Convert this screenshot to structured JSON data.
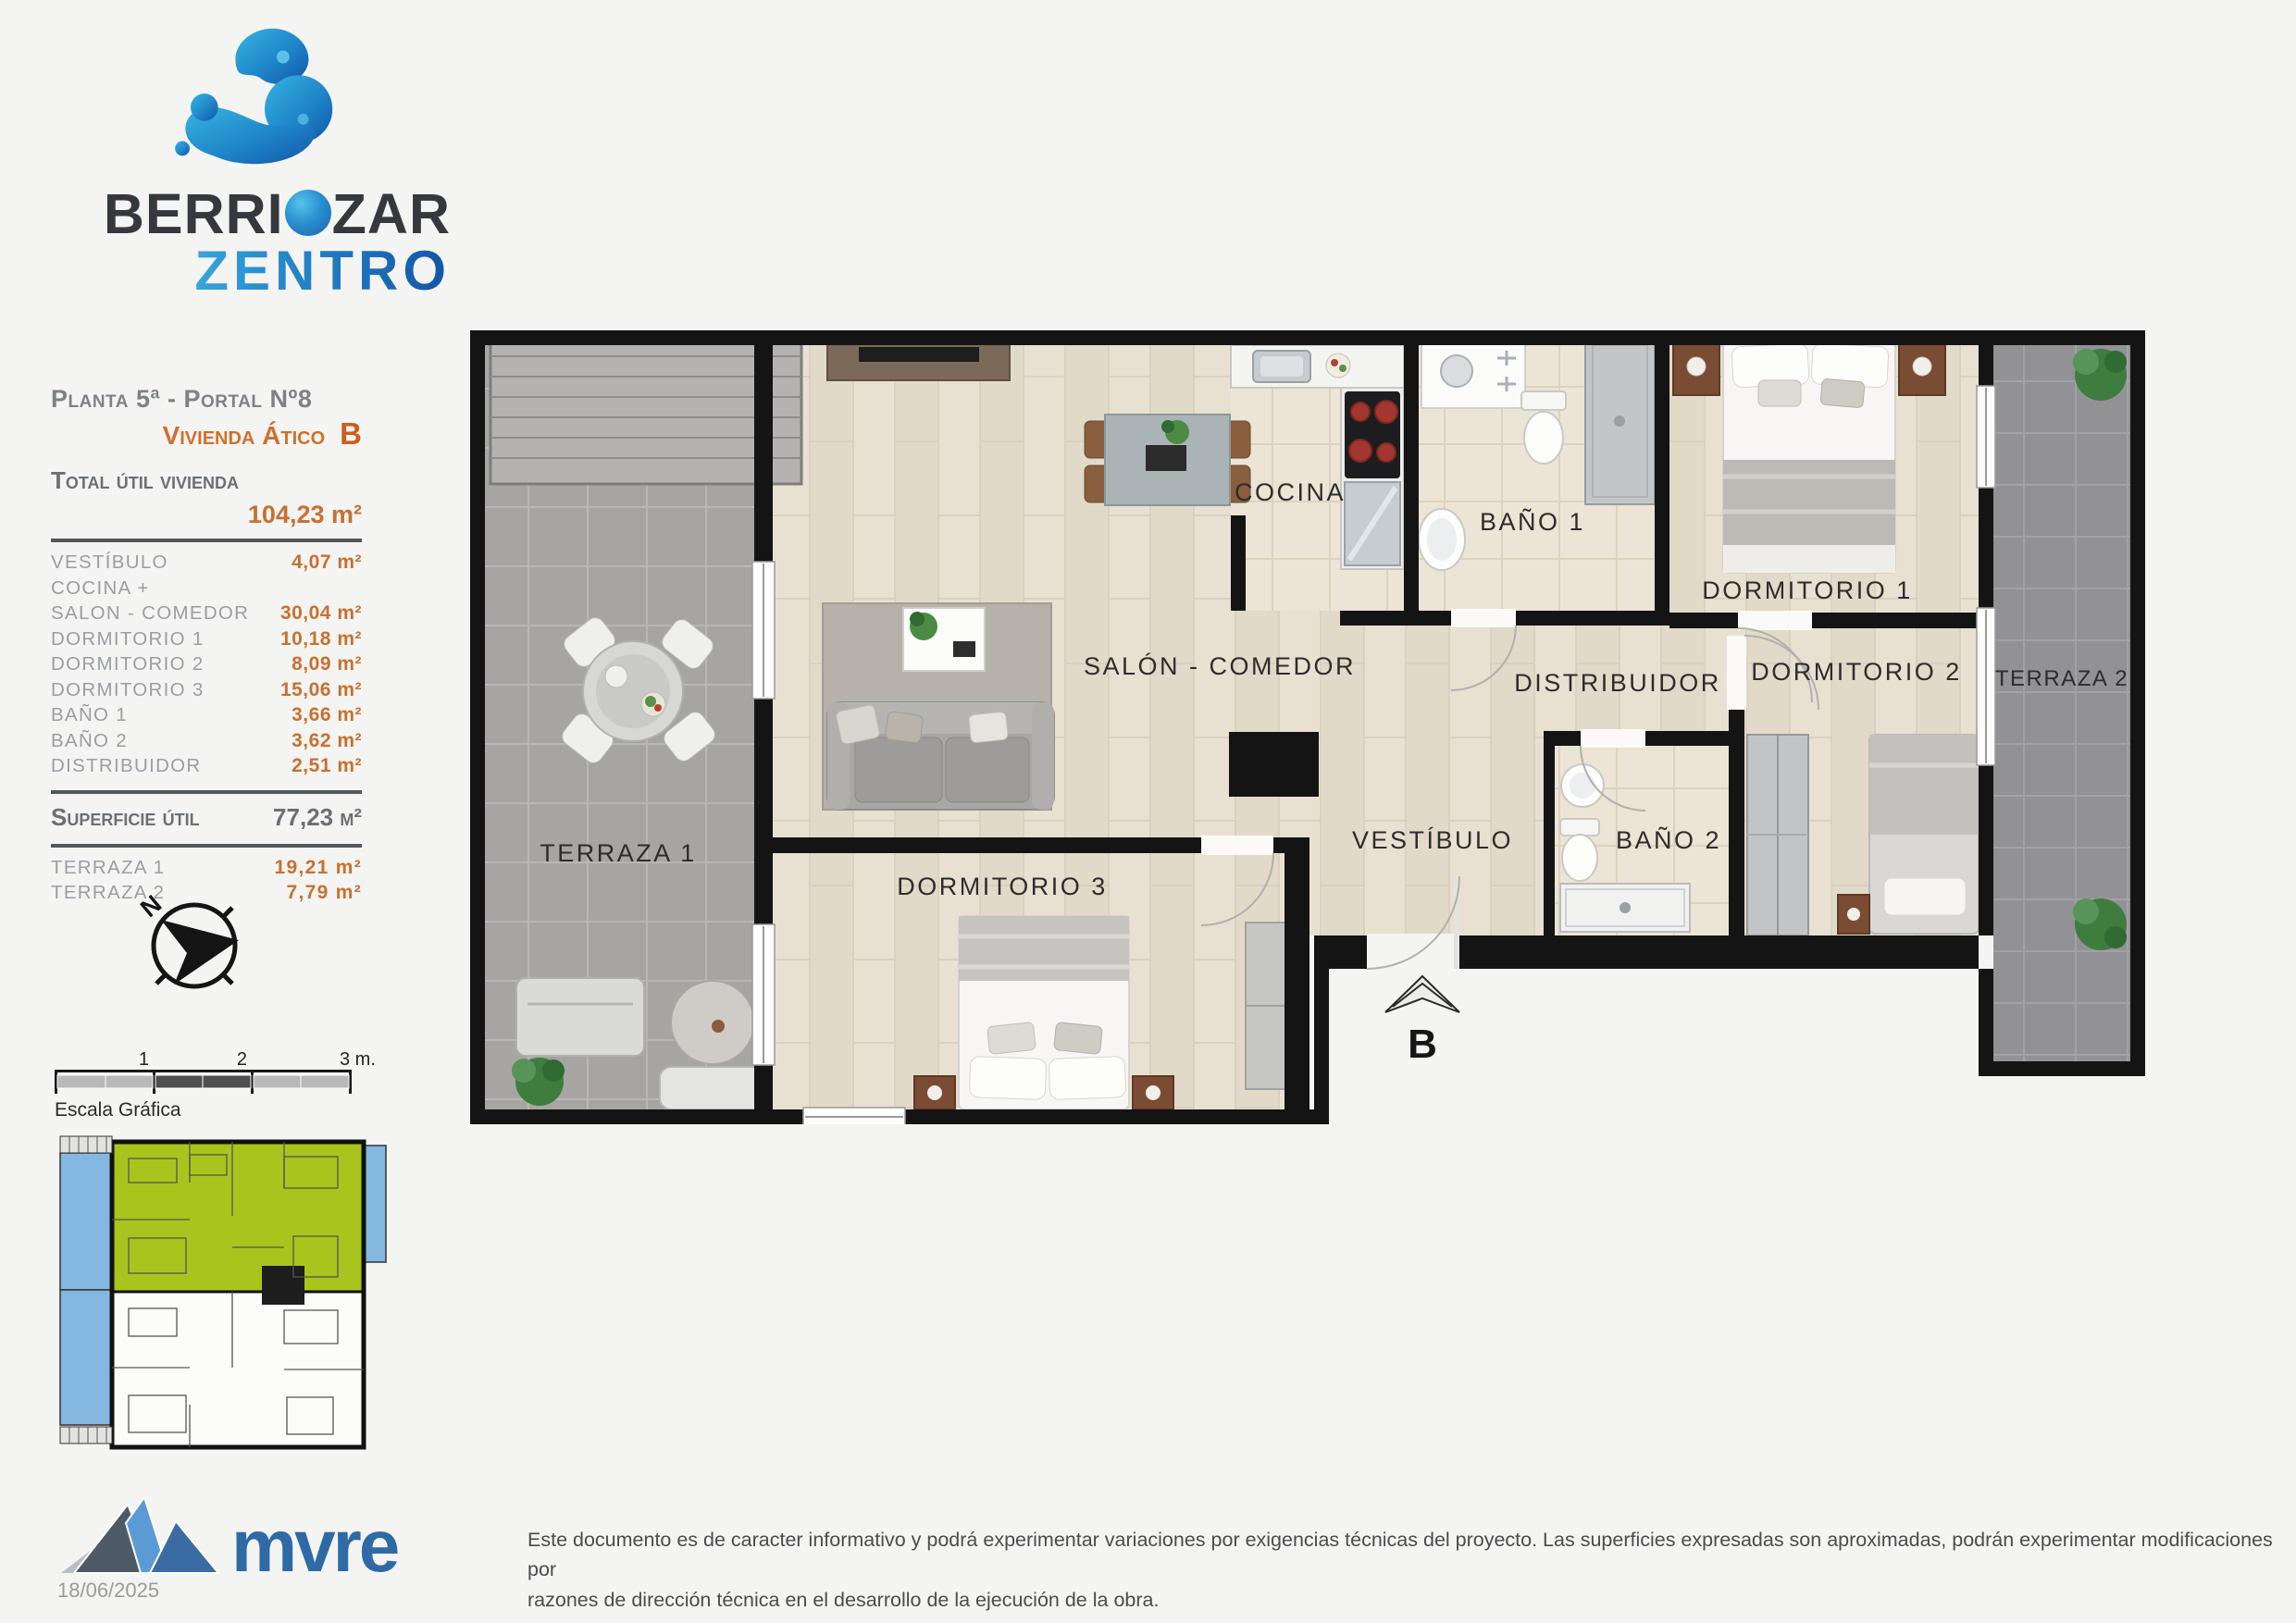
{
  "brand": {
    "prefix": "BERRI",
    "suffix": "ZAR",
    "bottom": "ZENTRO"
  },
  "info": {
    "planta": "Planta 5ª - Portal Nº8",
    "vivienda": "Vivienda Ático",
    "letra": "B",
    "total_label": "Total útil vivienda",
    "total_value": "104,23 m²",
    "rows": [
      {
        "label": "VESTÍBULO",
        "value": "4,07 m²"
      },
      {
        "label": "COCINA +",
        "value": ""
      },
      {
        "label": "SALON - COMEDOR",
        "value": "30,04 m²"
      },
      {
        "label": "DORMITORIO 1",
        "value": "10,18 m²"
      },
      {
        "label": "DORMITORIO 2",
        "value": "8,09 m²"
      },
      {
        "label": "DORMITORIO 3",
        "value": "15,06 m²"
      },
      {
        "label": "BAÑO 1",
        "value": "3,66 m²"
      },
      {
        "label": "BAÑO 2",
        "value": "3,62 m²"
      },
      {
        "label": "DISTRIBUIDOR",
        "value": "2,51 m²"
      }
    ],
    "superficie_label": "Superficie útil",
    "superficie_value": "77,23 m²",
    "terrazas": [
      {
        "label": "TERRAZA 1",
        "value": "19,21 m²"
      },
      {
        "label": "TERRAZA 2",
        "value": "7,79 m²"
      }
    ]
  },
  "plan": {
    "labels": {
      "terraza1": "TERRAZA 1",
      "salon": "SALÓN - COMEDOR",
      "cocina": "COCINA",
      "bano1": "BAÑO 1",
      "dormitorio1": "DORMITORIO 1",
      "distribuidor": "DISTRIBUIDOR",
      "dormitorio2": "DORMITORIO 2",
      "terraza2": "TERRAZA 2",
      "vestibulo": "VESTÍBULO",
      "bano2": "BAÑO 2",
      "dormitorio3": "DORMITORIO 3",
      "entrance": "B"
    }
  },
  "compass": {
    "north": "N"
  },
  "scalebar": {
    "tick1": "1",
    "tick2": "2",
    "tick3": "3 m.",
    "caption": "Escala Gráfica"
  },
  "footer": {
    "logo_text": "mvre",
    "date": "18/06/2025",
    "disclaimer_line1": "Este documento es de caracter informativo y podrá experimentar variaciones por exigencias técnicas del proyecto. Las superficies expresadas son aproximadas, podrán experimentar modificaciones por",
    "disclaimer_line2": "razones de dirección técnica en el desarrollo de la ejecución de la obra."
  },
  "colors": {
    "accent_orange": "#c9702e",
    "brand_blue": "#1f7ec6",
    "highlight_green": "#a9c41d",
    "terrace_blue": "#84b8e1",
    "wall_black": "#141414"
  }
}
